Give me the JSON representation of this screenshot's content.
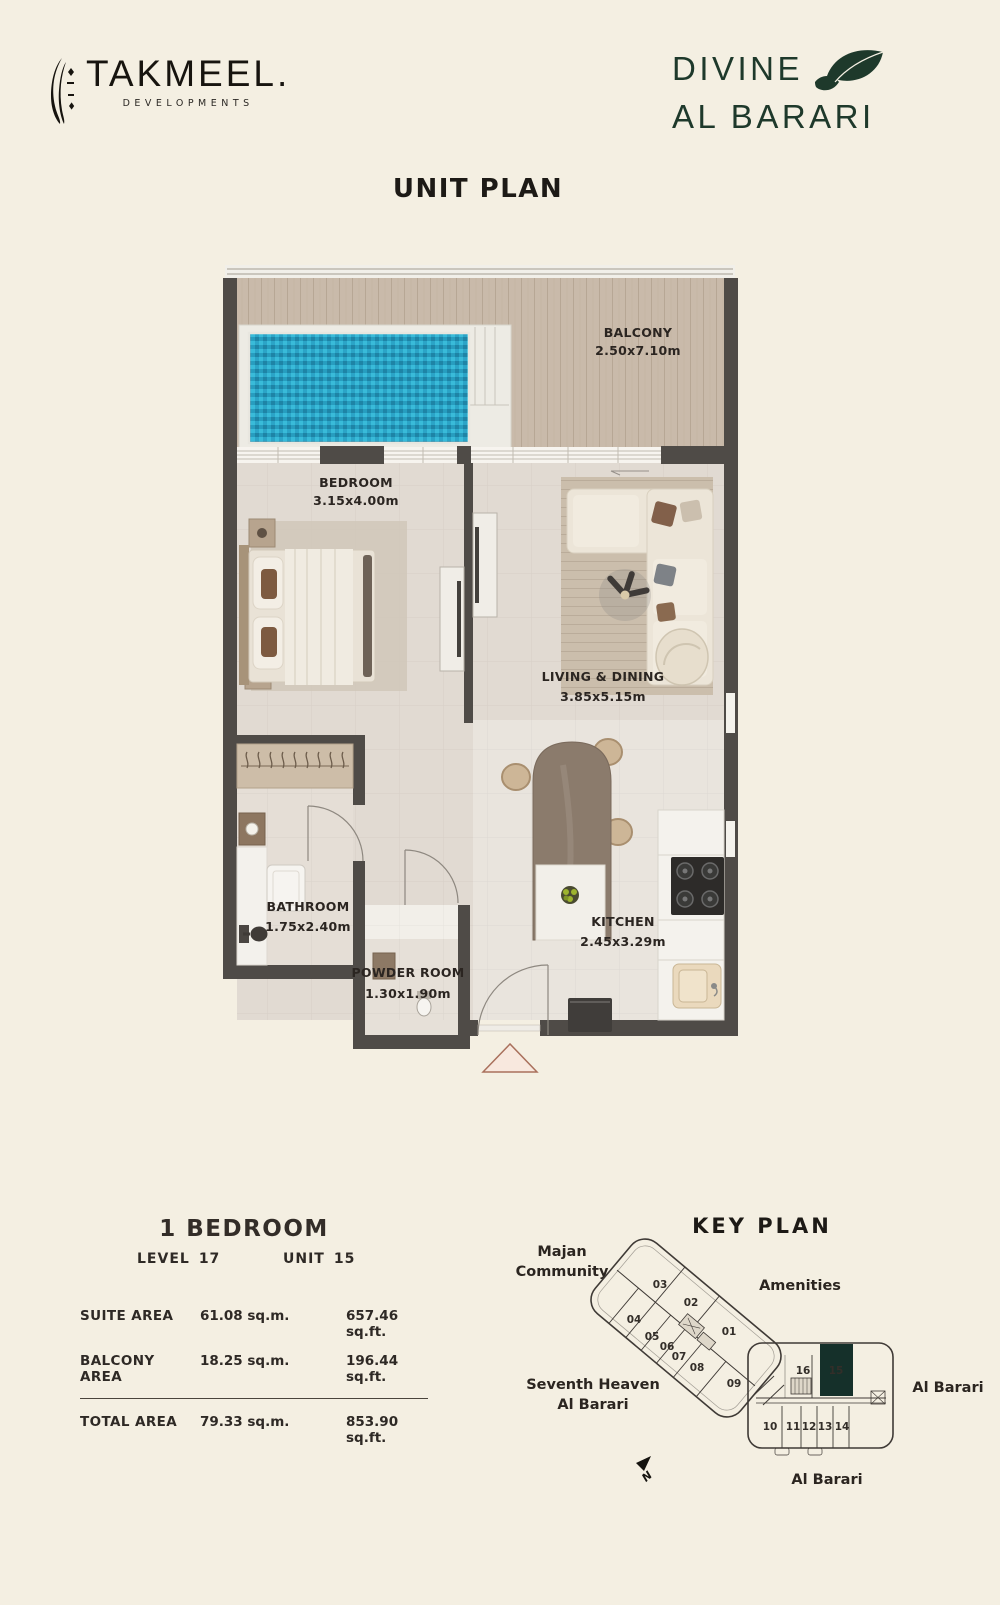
{
  "colors": {
    "background": "#f4efe2",
    "wall": "#4f4b47",
    "pool": "#2aa5c8",
    "accent_green": "#15302a",
    "logo_green": "#1e392b"
  },
  "header": {
    "takmeel": {
      "wordmark": "TAKMEEL.",
      "subtitle": "DEVELOPMENTS"
    },
    "divine": {
      "line1": "DIVINE",
      "line2": "AL BARARI"
    }
  },
  "title": "UNIT PLAN",
  "floor_plan": {
    "rooms": [
      {
        "name": "BALCONY",
        "dims": "2.50x7.10m"
      },
      {
        "name": "BEDROOM",
        "dims": "3.15x4.00m"
      },
      {
        "name": "LIVING & DINING",
        "dims": "3.85x5.15m"
      },
      {
        "name": "BATHROOM",
        "dims": "1.75x2.40m"
      },
      {
        "name": "POWDER ROOM",
        "dims": "1.30x1.90m"
      },
      {
        "name": "KITCHEN",
        "dims": "2.45x3.29m"
      }
    ]
  },
  "unit_info": {
    "type": "1 BEDROOM",
    "level_label": "LEVEL",
    "level_value": "17",
    "unit_label": "UNIT",
    "unit_value": "15",
    "areas": [
      {
        "label": "SUITE AREA",
        "sqm": "61.08 sq.m.",
        "sqft": "657.46 sq.ft."
      },
      {
        "label": "BALCONY AREA",
        "sqm": "18.25 sq.m.",
        "sqft": "196.44 sq.ft."
      },
      {
        "label": "TOTAL AREA",
        "sqm": "79.33 sq.m.",
        "sqft": "853.90 sq.ft."
      }
    ]
  },
  "key_plan": {
    "title": "KEY PLAN",
    "labels": {
      "majan_line1": "Majan",
      "majan_line2": "Community",
      "amenities": "Amenities",
      "seventh_line1": "Seventh Heaven",
      "seventh_line2": "Al Barari",
      "al_barari_right": "Al Barari",
      "al_barari_bottom": "Al Barari"
    },
    "north_label": "N",
    "highlighted_unit": "15",
    "units": {
      "u01": "01",
      "u02": "02",
      "u03": "03",
      "u04": "04",
      "u05": "05",
      "u06": "06",
      "u07": "07",
      "u08": "08",
      "u09": "09",
      "u10": "10",
      "u11": "11",
      "u12": "12",
      "u13": "13",
      "u14": "14",
      "u15": "15",
      "u16": "16"
    }
  }
}
